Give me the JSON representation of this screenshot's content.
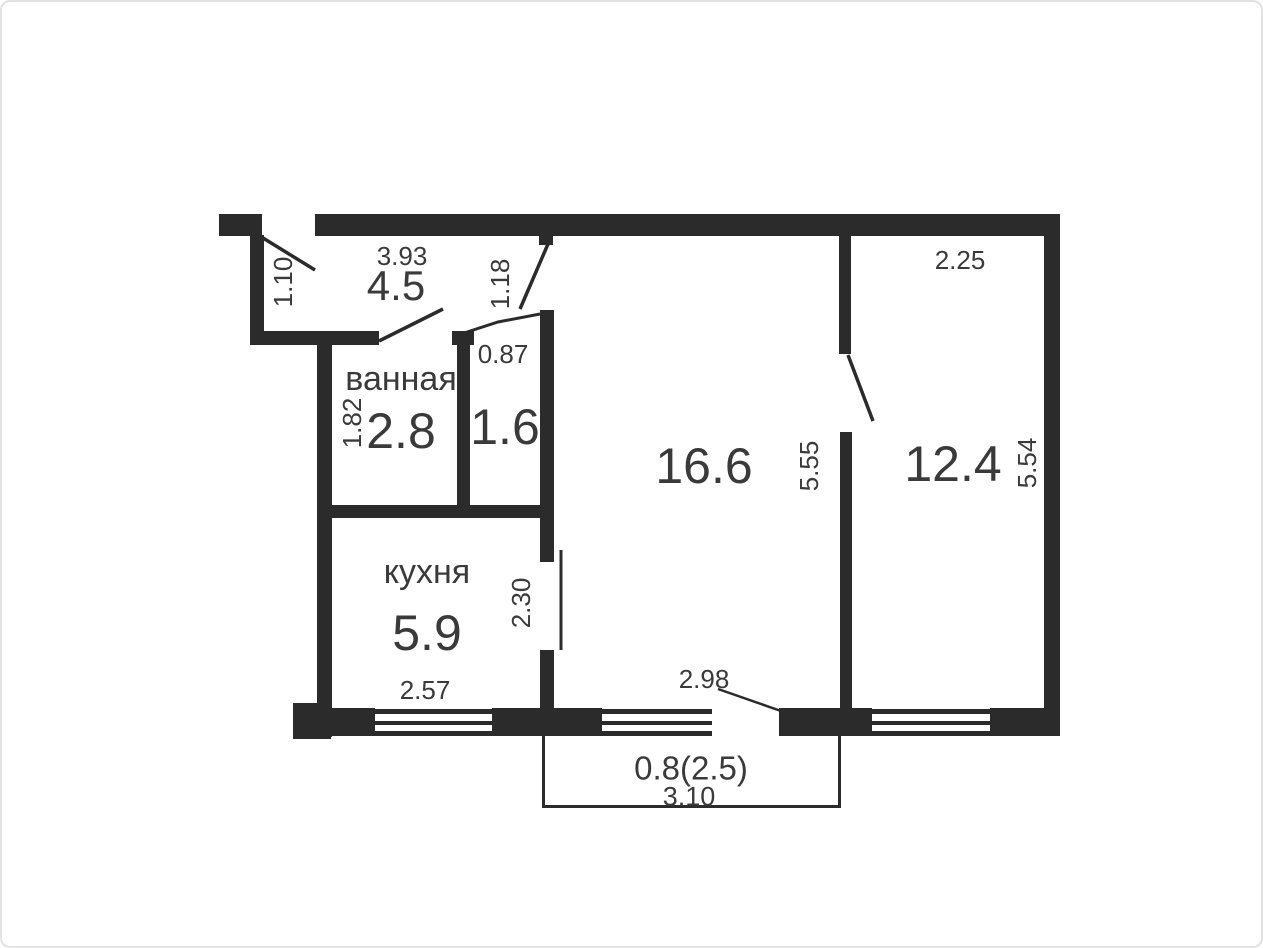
{
  "colors": {
    "wall": "#2b2b2b",
    "text": "#3a3a3a",
    "background": "#ffffff",
    "frame": "#e2e2e2"
  },
  "rooms": {
    "hall": {
      "area": "4.5",
      "width_dim": "3.93",
      "side_dim": "1.10",
      "door_dim": "1.18"
    },
    "bathroom": {
      "name": "ванная",
      "area": "2.8",
      "side_dim": "1.82"
    },
    "storage": {
      "area": "1.6",
      "door_dim": "0.87"
    },
    "kitchen": {
      "name": "кухня",
      "area": "5.9",
      "width_dim": "2.57",
      "opening_dim": "2.30"
    },
    "living": {
      "area": "16.6",
      "side_dim": "5.55",
      "bottom_dim": "2.98"
    },
    "bedroom": {
      "area": "12.4",
      "top_dim": "2.25",
      "side_dim": "5.54"
    },
    "balcony": {
      "area": "0.8(2.5)",
      "width_dim": "3.10"
    }
  }
}
